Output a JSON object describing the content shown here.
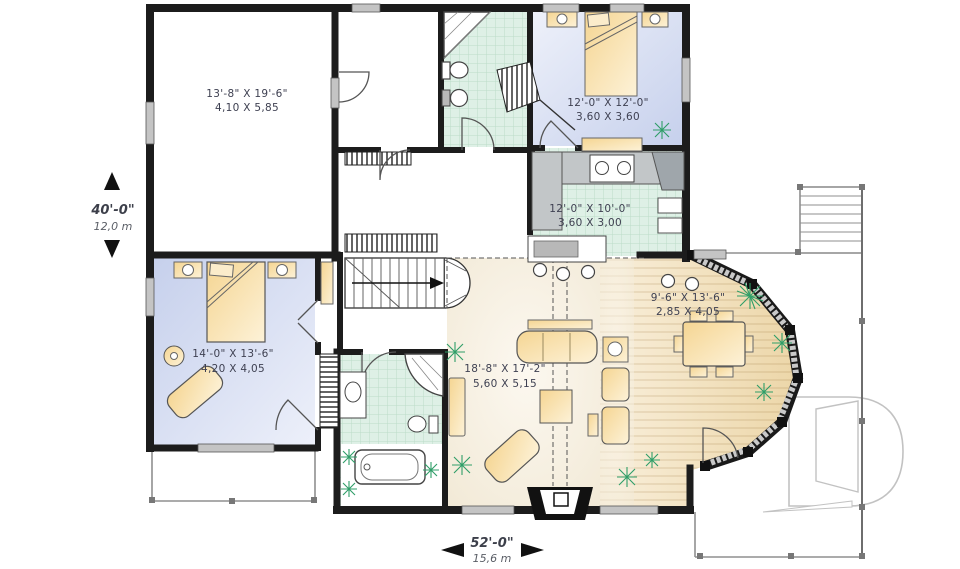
{
  "plan": {
    "rooms": [
      {
        "id": "garage",
        "imperial": "13'-8\" X 19'-6\"",
        "metric": "4,10 X 5,85"
      },
      {
        "id": "bedroom-upper",
        "imperial": "12'-0\" X 12'-0\"",
        "metric": "3,60 X 3,60"
      },
      {
        "id": "kitchen",
        "imperial": "12'-0\" X 10'-0\"",
        "metric": "3,60 X 3,00"
      },
      {
        "id": "dining-nook",
        "imperial": "9'-6\" X 13'-6\"",
        "metric": "2,85 X 4,05"
      },
      {
        "id": "master-bedroom",
        "imperial": "14'-0\" X 13'-6\"",
        "metric": "4,20 X 4,05"
      },
      {
        "id": "living-room",
        "imperial": "18'-8\" X 17'-2\"",
        "metric": "5,60 X 5,15"
      }
    ],
    "dimensions": {
      "depth": {
        "imperial": "40'-0\"",
        "metric": "12,0 m"
      },
      "width": {
        "imperial": "52'-0\"",
        "metric": "15,6 m"
      }
    },
    "logo": {
      "letter": "D"
    },
    "colors": {
      "walls": "#1c1c1c",
      "bedroom_floor": "#ccd5ee",
      "tile_floor": "#def0e6",
      "wood_floor": "#f0ddb6",
      "living_floor": "#f7f0e2",
      "furniture": "#f6dca2",
      "plants": "#2f9e68",
      "deck_rail": "#8f8f8f",
      "window_fill": "#c4c4c4"
    }
  }
}
